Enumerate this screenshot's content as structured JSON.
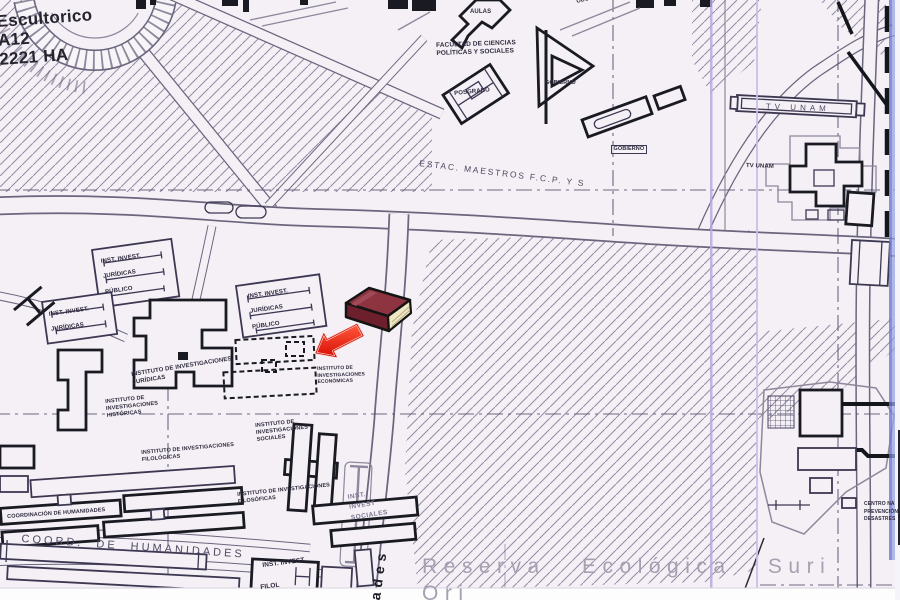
{
  "map": {
    "colors": {
      "paper": "#f4f0f6",
      "ink": "#1a1a22",
      "line": "#6b657d",
      "label": "#2e2a3c",
      "faint": "#a6a1b2",
      "hatch": "#978fa6",
      "arrow": "#e8150c",
      "bookcover": "#8e3340",
      "bookpages": "#efe8c2",
      "stripe": "#b7a8df"
    },
    "region_labels": {
      "sheet_note": "Escultorico\nA12\n2221 HA",
      "aulas": "AULAS",
      "facultad_cps": "FACULTAD DE CIENCIAS\nPOLÍTICAS Y SOCIALES",
      "posgrado": "POSGRADO",
      "gobierno_upper": "GOBIERNO",
      "gobierno_lower": "GOBIERNO",
      "odontologica": "ODONTOLÓGICA",
      "estacionamiento_maestros": "ESTAC. MAESTROS F.C.P. Y S",
      "tv_unam_street": "TV UNAM",
      "tv_unam_building": "TV UNAM",
      "inst_invest_juridicas_north": "INST. INVEST.\nJURÍDICAS\nPÚBLICO",
      "inst_invest_juridicas_west": "INST. INVEST.\nJURÍDICAS",
      "inst_invest_juridicas_east": "INST. INVEST.\nJURÍDICAS\nPÚBLICO",
      "instituto_juridicas": "INSTITUTO DE INVESTIGACIONES\nJURÍDICAS",
      "instituto_historicas": "INSTITUTO DE\nINVESTIGACIONES\nHISTÓRICAS",
      "instituto_economicas": "INSTITUTO DE\nINVESTIGACIONES\nECONÓMICAS",
      "instituto_sociales": "INSTITUTO DE\nINVESTIGACIONES\nSOCIALES",
      "instituto_filologicas": "INSTITUTO DE INVESTIGACIONES\nFILOLÓGICAS",
      "instituto_filosoficas": "INSTITUTO DE INVESTIGACIONES\nFILOSÓFICAS",
      "inst_invest_sociales": "INST.\nINVEST\nSOCIALES",
      "coordinacion_humanidades": "COORDINACIÓN DE HUMANIDADES",
      "coord_de_humanidades": "COORD. DE HUMANIDADES",
      "inst_invest_south": "INST. INVEST.",
      "filologicas_south_partial": "FILOL",
      "centro_prevencion_desastres": "CENTRO NA\nPREVENCIÓN\nDESASTRES",
      "reserva_ecologica": "Reserva Ecológica Suri Ori",
      "street_name_partial": "ades"
    },
    "overlay": {
      "book_icon": "book-icon",
      "arrow_icon": "red-arrow-icon"
    }
  }
}
